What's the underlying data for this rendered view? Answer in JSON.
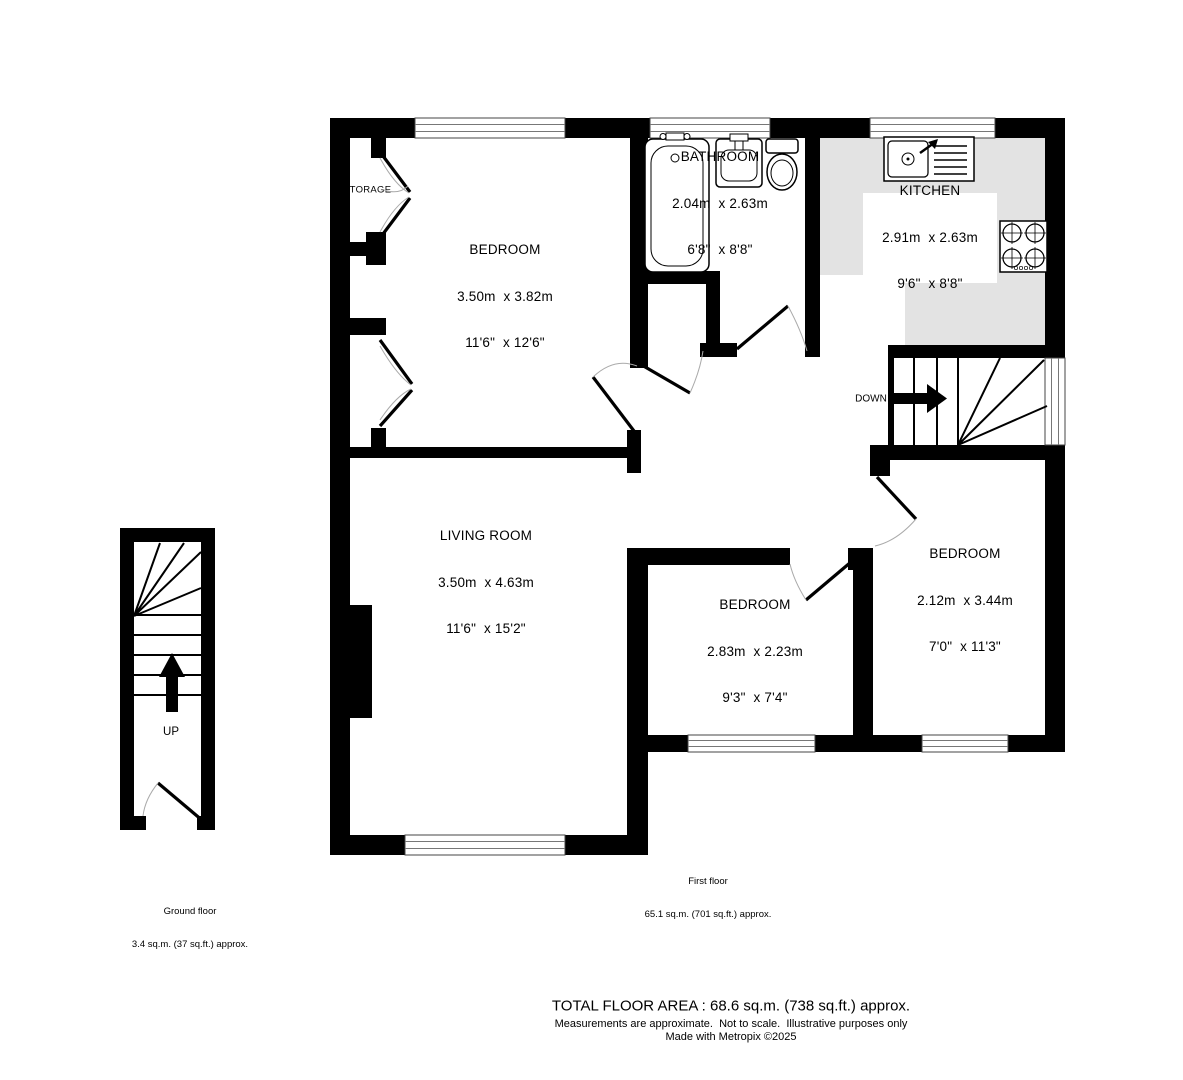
{
  "rooms": {
    "bedroom1": {
      "name": "BEDROOM",
      "metric": "3.50m  x 3.82m",
      "imperial": "11'6\"  x 12'6\""
    },
    "bathroom": {
      "name": "BATHROOM",
      "metric": "2.04m  x 2.63m",
      "imperial": "6'8\"  x 8'8\""
    },
    "kitchen": {
      "name": "KITCHEN",
      "metric": "2.91m  x 2.63m",
      "imperial": "9'6\"  x 8'8\""
    },
    "living_room": {
      "name": "LIVING ROOM",
      "metric": "3.50m  x 4.63m",
      "imperial": "11'6\"  x 15'2\""
    },
    "bedroom2": {
      "name": "BEDROOM",
      "metric": "2.83m  x 2.23m",
      "imperial": "9'3\"  x 7'4\""
    },
    "bedroom3": {
      "name": "BEDROOM",
      "metric": "2.12m  x 3.44m",
      "imperial": "7'0\"  x 11'3\""
    }
  },
  "annotations": {
    "storage": "STORAGE",
    "down": "DOWN",
    "up": "UP"
  },
  "floor_summaries": {
    "first_floor": {
      "name": "First floor",
      "area": "65.1 sq.m. (701 sq.ft.) approx."
    },
    "ground_floor": {
      "name": "Ground floor",
      "area": "3.4 sq.m. (37 sq.ft.) approx."
    }
  },
  "footer": {
    "total_area": "TOTAL FLOOR AREA : 68.6 sq.m. (738 sq.ft.) approx.",
    "disclaimer": "Measurements are approximate.  Not to scale.  Illustrative purposes only",
    "credit": "Made with Metropix ©2025"
  },
  "colors": {
    "wall": "#000000",
    "counter": "#e3e3e3",
    "window_line": "#777777",
    "door_arc": "#aaaaaa"
  }
}
